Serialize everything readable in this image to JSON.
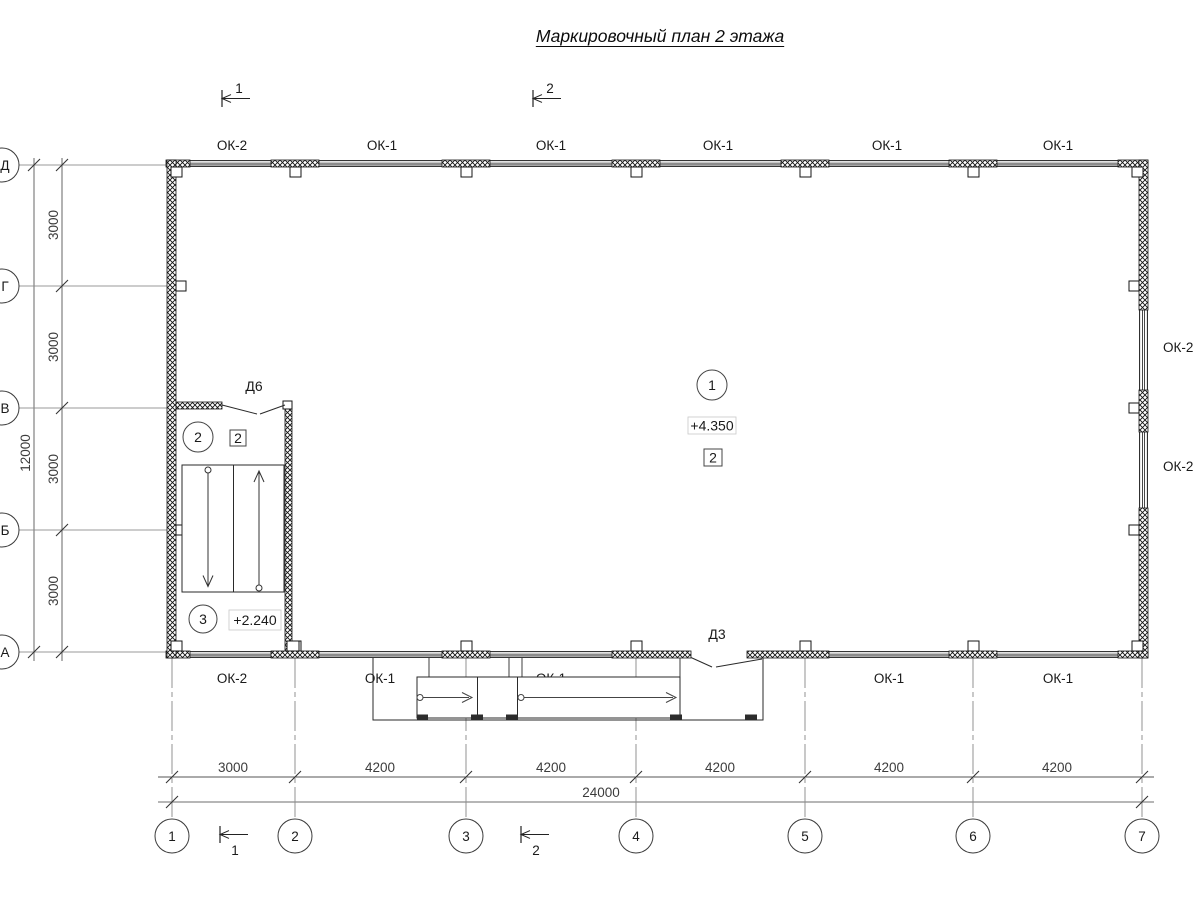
{
  "title": "Маркировочный план 2 этажа",
  "section_markers": {
    "top_1": "1",
    "top_2": "2",
    "bottom_1": "1",
    "bottom_2": "2"
  },
  "grid_axes": {
    "columns": [
      "1",
      "2",
      "3",
      "4",
      "5",
      "6",
      "7"
    ],
    "rows": [
      "Д",
      "Г",
      "В",
      "Б",
      "А"
    ]
  },
  "dimensions": {
    "bottom_segments": [
      "3000",
      "4200",
      "4200",
      "4200",
      "4200",
      "4200"
    ],
    "bottom_total": "24000",
    "left_segments": [
      "3000",
      "3000",
      "3000",
      "3000"
    ],
    "left_total": "12000"
  },
  "window_labels": {
    "top": [
      "ОК-2",
      "ОК-1",
      "ОК-1",
      "ОК-1",
      "ОК-1",
      "ОК-1"
    ],
    "bottom": [
      "ОК-2",
      "ОК-1",
      "ОК-1",
      "ОК-1",
      "ОК-1"
    ],
    "right": [
      "ОК-2",
      "ОК-2"
    ]
  },
  "door_labels": {
    "d6": "Д6",
    "d3": "Д3"
  },
  "room_marks": {
    "hall": {
      "number": "1",
      "elevation": "+4.350",
      "finish_tag": "2"
    },
    "stair_upper": {
      "number": "2",
      "finish_tag": "2"
    },
    "stair_lower": {
      "number": "3",
      "elevation": "+2.240"
    }
  }
}
